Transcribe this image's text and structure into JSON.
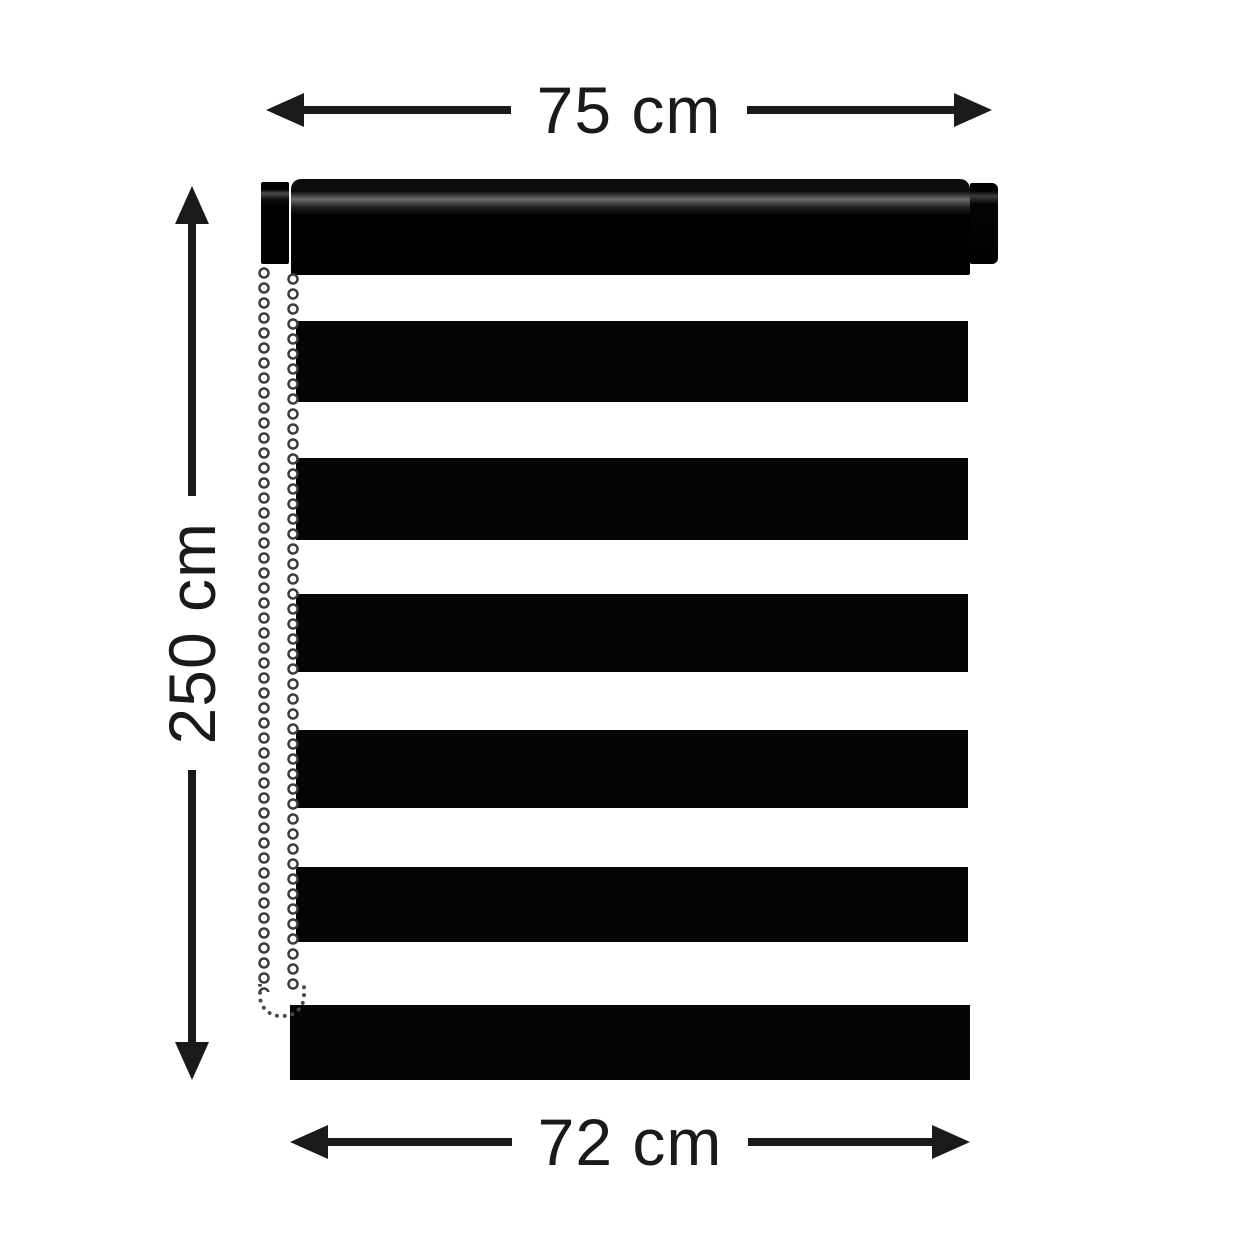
{
  "diagram": {
    "ink_color": "#1a1a1a",
    "blind_color": "#050505",
    "background_color": "#ffffff",
    "top_dimension": {
      "label": "75 cm"
    },
    "left_dimension": {
      "label": "250 cm"
    },
    "bottom_dimension": {
      "label": "72 cm"
    },
    "blind": {
      "stripe_count": 6,
      "parts": [
        "mounting-bracket",
        "roller-tube",
        "end-cap",
        "bead-chain",
        "fabric-stripes"
      ]
    }
  }
}
